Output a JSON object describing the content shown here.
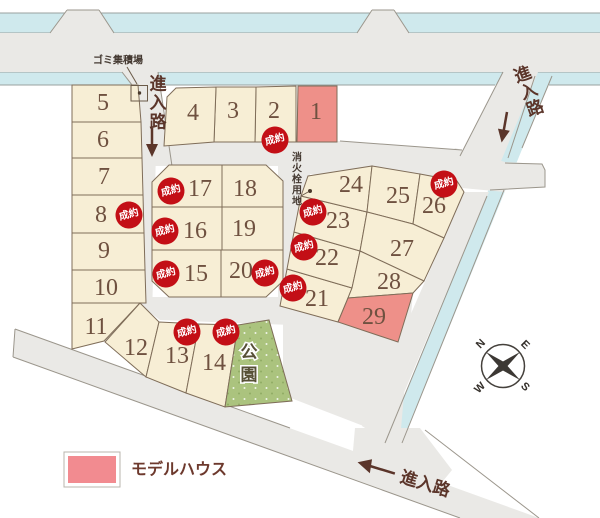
{
  "legend": {
    "label": "モデルハウス"
  },
  "labels": {
    "garbage_site": "ゴミ集積場",
    "hydrant_site": "消火栓用地",
    "park": "公園",
    "entry_road": "進入路",
    "sold_badge": "成約"
  },
  "chars": {
    "entry": [
      "進",
      "入",
      "路"
    ],
    "hydrant": [
      "消",
      "火",
      "栓",
      "用",
      "地"
    ],
    "park": [
      "公",
      "園"
    ]
  },
  "compass": {
    "n": "N",
    "e": "E",
    "s": "S",
    "w": "W"
  },
  "lots": [
    {
      "num": "1",
      "type": "model_house",
      "sold": false
    },
    {
      "num": "2",
      "type": "standard",
      "sold": true
    },
    {
      "num": "3",
      "type": "standard",
      "sold": false
    },
    {
      "num": "4",
      "type": "standard",
      "sold": false
    },
    {
      "num": "5",
      "type": "standard",
      "sold": false
    },
    {
      "num": "6",
      "type": "standard",
      "sold": false
    },
    {
      "num": "7",
      "type": "standard",
      "sold": false
    },
    {
      "num": "8",
      "type": "standard",
      "sold": true
    },
    {
      "num": "9",
      "type": "standard",
      "sold": false
    },
    {
      "num": "10",
      "type": "standard",
      "sold": false
    },
    {
      "num": "11",
      "type": "standard",
      "sold": false
    },
    {
      "num": "12",
      "type": "standard",
      "sold": false
    },
    {
      "num": "13",
      "type": "standard",
      "sold": true
    },
    {
      "num": "14",
      "type": "standard",
      "sold": true
    },
    {
      "num": "15",
      "type": "standard",
      "sold": true
    },
    {
      "num": "16",
      "type": "standard",
      "sold": true
    },
    {
      "num": "17",
      "type": "standard",
      "sold": true
    },
    {
      "num": "18",
      "type": "standard",
      "sold": false
    },
    {
      "num": "19",
      "type": "standard",
      "sold": false
    },
    {
      "num": "20",
      "type": "standard",
      "sold": true
    },
    {
      "num": "21",
      "type": "standard",
      "sold": true
    },
    {
      "num": "22",
      "type": "standard",
      "sold": true
    },
    {
      "num": "23",
      "type": "standard",
      "sold": true
    },
    {
      "num": "24",
      "type": "standard",
      "sold": false
    },
    {
      "num": "25",
      "type": "standard",
      "sold": false
    },
    {
      "num": "26",
      "type": "standard",
      "sold": true
    },
    {
      "num": "27",
      "type": "standard",
      "sold": false
    },
    {
      "num": "28",
      "type": "standard",
      "sold": false
    },
    {
      "num": "29",
      "type": "model_house",
      "sold": false
    }
  ],
  "colors": {
    "lot_fill": "#f7eed5",
    "lot_border": "#7f6d59",
    "model_house_pink": "#ee9089",
    "legend_pink": "#f28b90",
    "road_gray": "#eae9e6",
    "road_border": "#9b968c",
    "water_blue": "#cfe9ed",
    "park_green": "#abc37e",
    "badge_red": "#c30f16",
    "badge_text": "#ffffff",
    "number_brown": "#6f5140",
    "label_brown": "#5b352a"
  }
}
